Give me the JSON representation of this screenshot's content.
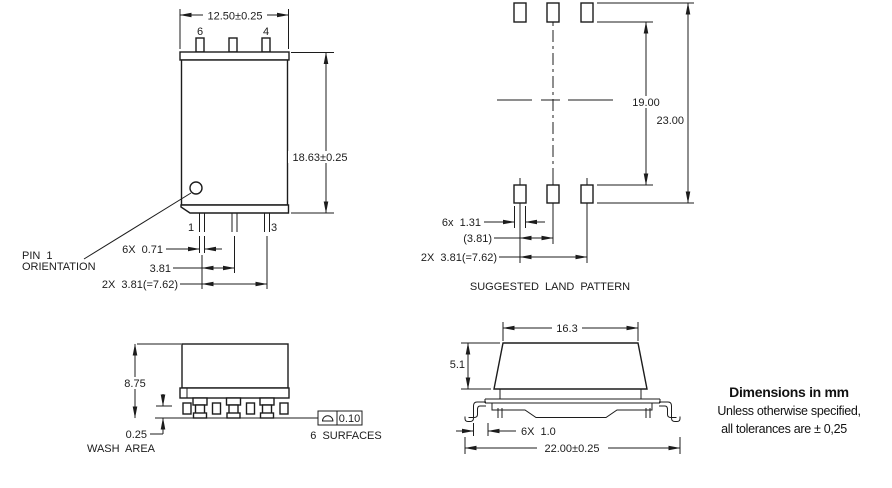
{
  "drawing": {
    "front_view": {
      "dim_width": "12.50±0.25",
      "dim_height": "18.63±0.25",
      "top_pin_left_num": "6",
      "top_pin_right_num": "4",
      "bottom_pin_left_num": "1",
      "bottom_pin_right_num": "3",
      "dim_lead_width": "6X 0.71",
      "dim_lead_pitch": "3.81",
      "dim_lead_span": "2X 3.81(=7.62)",
      "pin1_callout_line1": "PIN 1",
      "pin1_callout_line2": "ORIENTATION"
    },
    "land_pattern": {
      "caption": "SUGGESTED LAND PATTERN",
      "dim_pad_inner_span": "19.00",
      "dim_pad_outer_span": "23.00",
      "dim_pad_width": "6x 1.31",
      "dim_pad_pitch": "(3.81)",
      "dim_pad_span": "2X 3.81(=7.62)"
    },
    "side_view": {
      "dim_height": "8.75",
      "dim_standoff": "0.25",
      "standoff_note": "WASH AREA",
      "profile_tolerance": "0.10",
      "profile_note": "6 SURFACES"
    },
    "end_view": {
      "dim_lid_width": "16.3",
      "dim_lid_height": "5.1",
      "dim_lead_foot": "6X 1.0",
      "dim_overall_width": "22.00±0.25"
    },
    "general_notes": {
      "line1": "Dimensions in mm",
      "line2": "Unless otherwise specified,",
      "line3": "all tolerances are ± 0,25"
    },
    "colors": {
      "line": "#1c1c1c",
      "background": "#ffffff",
      "note_text": "#111111"
    }
  }
}
